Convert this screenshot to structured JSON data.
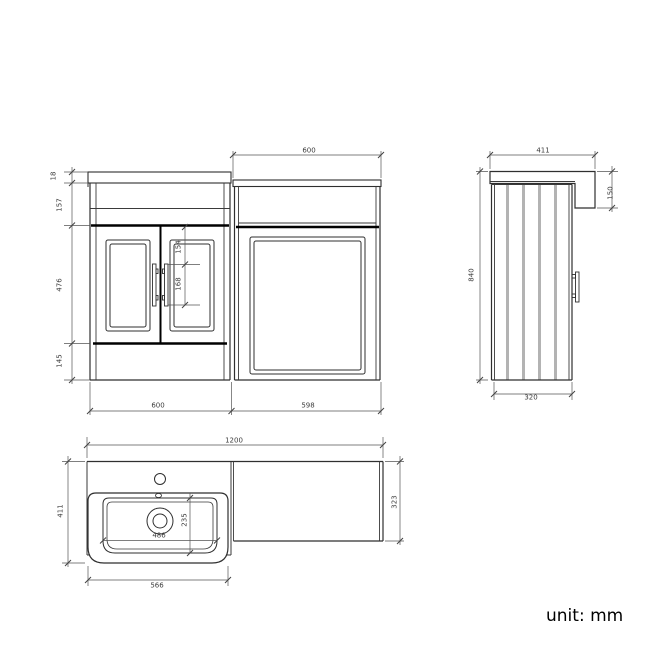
{
  "drawing": {
    "unit_label": "unit: mm",
    "colors": {
      "line": "#2f2f2f",
      "bold_line": "#000000",
      "dim_line": "#555555",
      "slat_fill": "#b3b3b3",
      "background": "#ffffff"
    },
    "front_view": {
      "worktop_thickness": "18",
      "fascia_height": "157",
      "door_height": "476",
      "plinth_height": "145",
      "panel_top_to_handle": "154",
      "handle_length": "168",
      "wc_top_width": "600",
      "vanity_width": "600",
      "wc_width": "598"
    },
    "side_view": {
      "worktop_depth": "411",
      "worktop_drop": "150",
      "total_height": "840",
      "cabinet_depth": "320"
    },
    "plan_view": {
      "total_width": "1200",
      "basin_unit_depth": "411",
      "wc_unit_depth": "323",
      "bowl_width": "486",
      "bowl_depth": "235",
      "basin_width": "566"
    }
  }
}
